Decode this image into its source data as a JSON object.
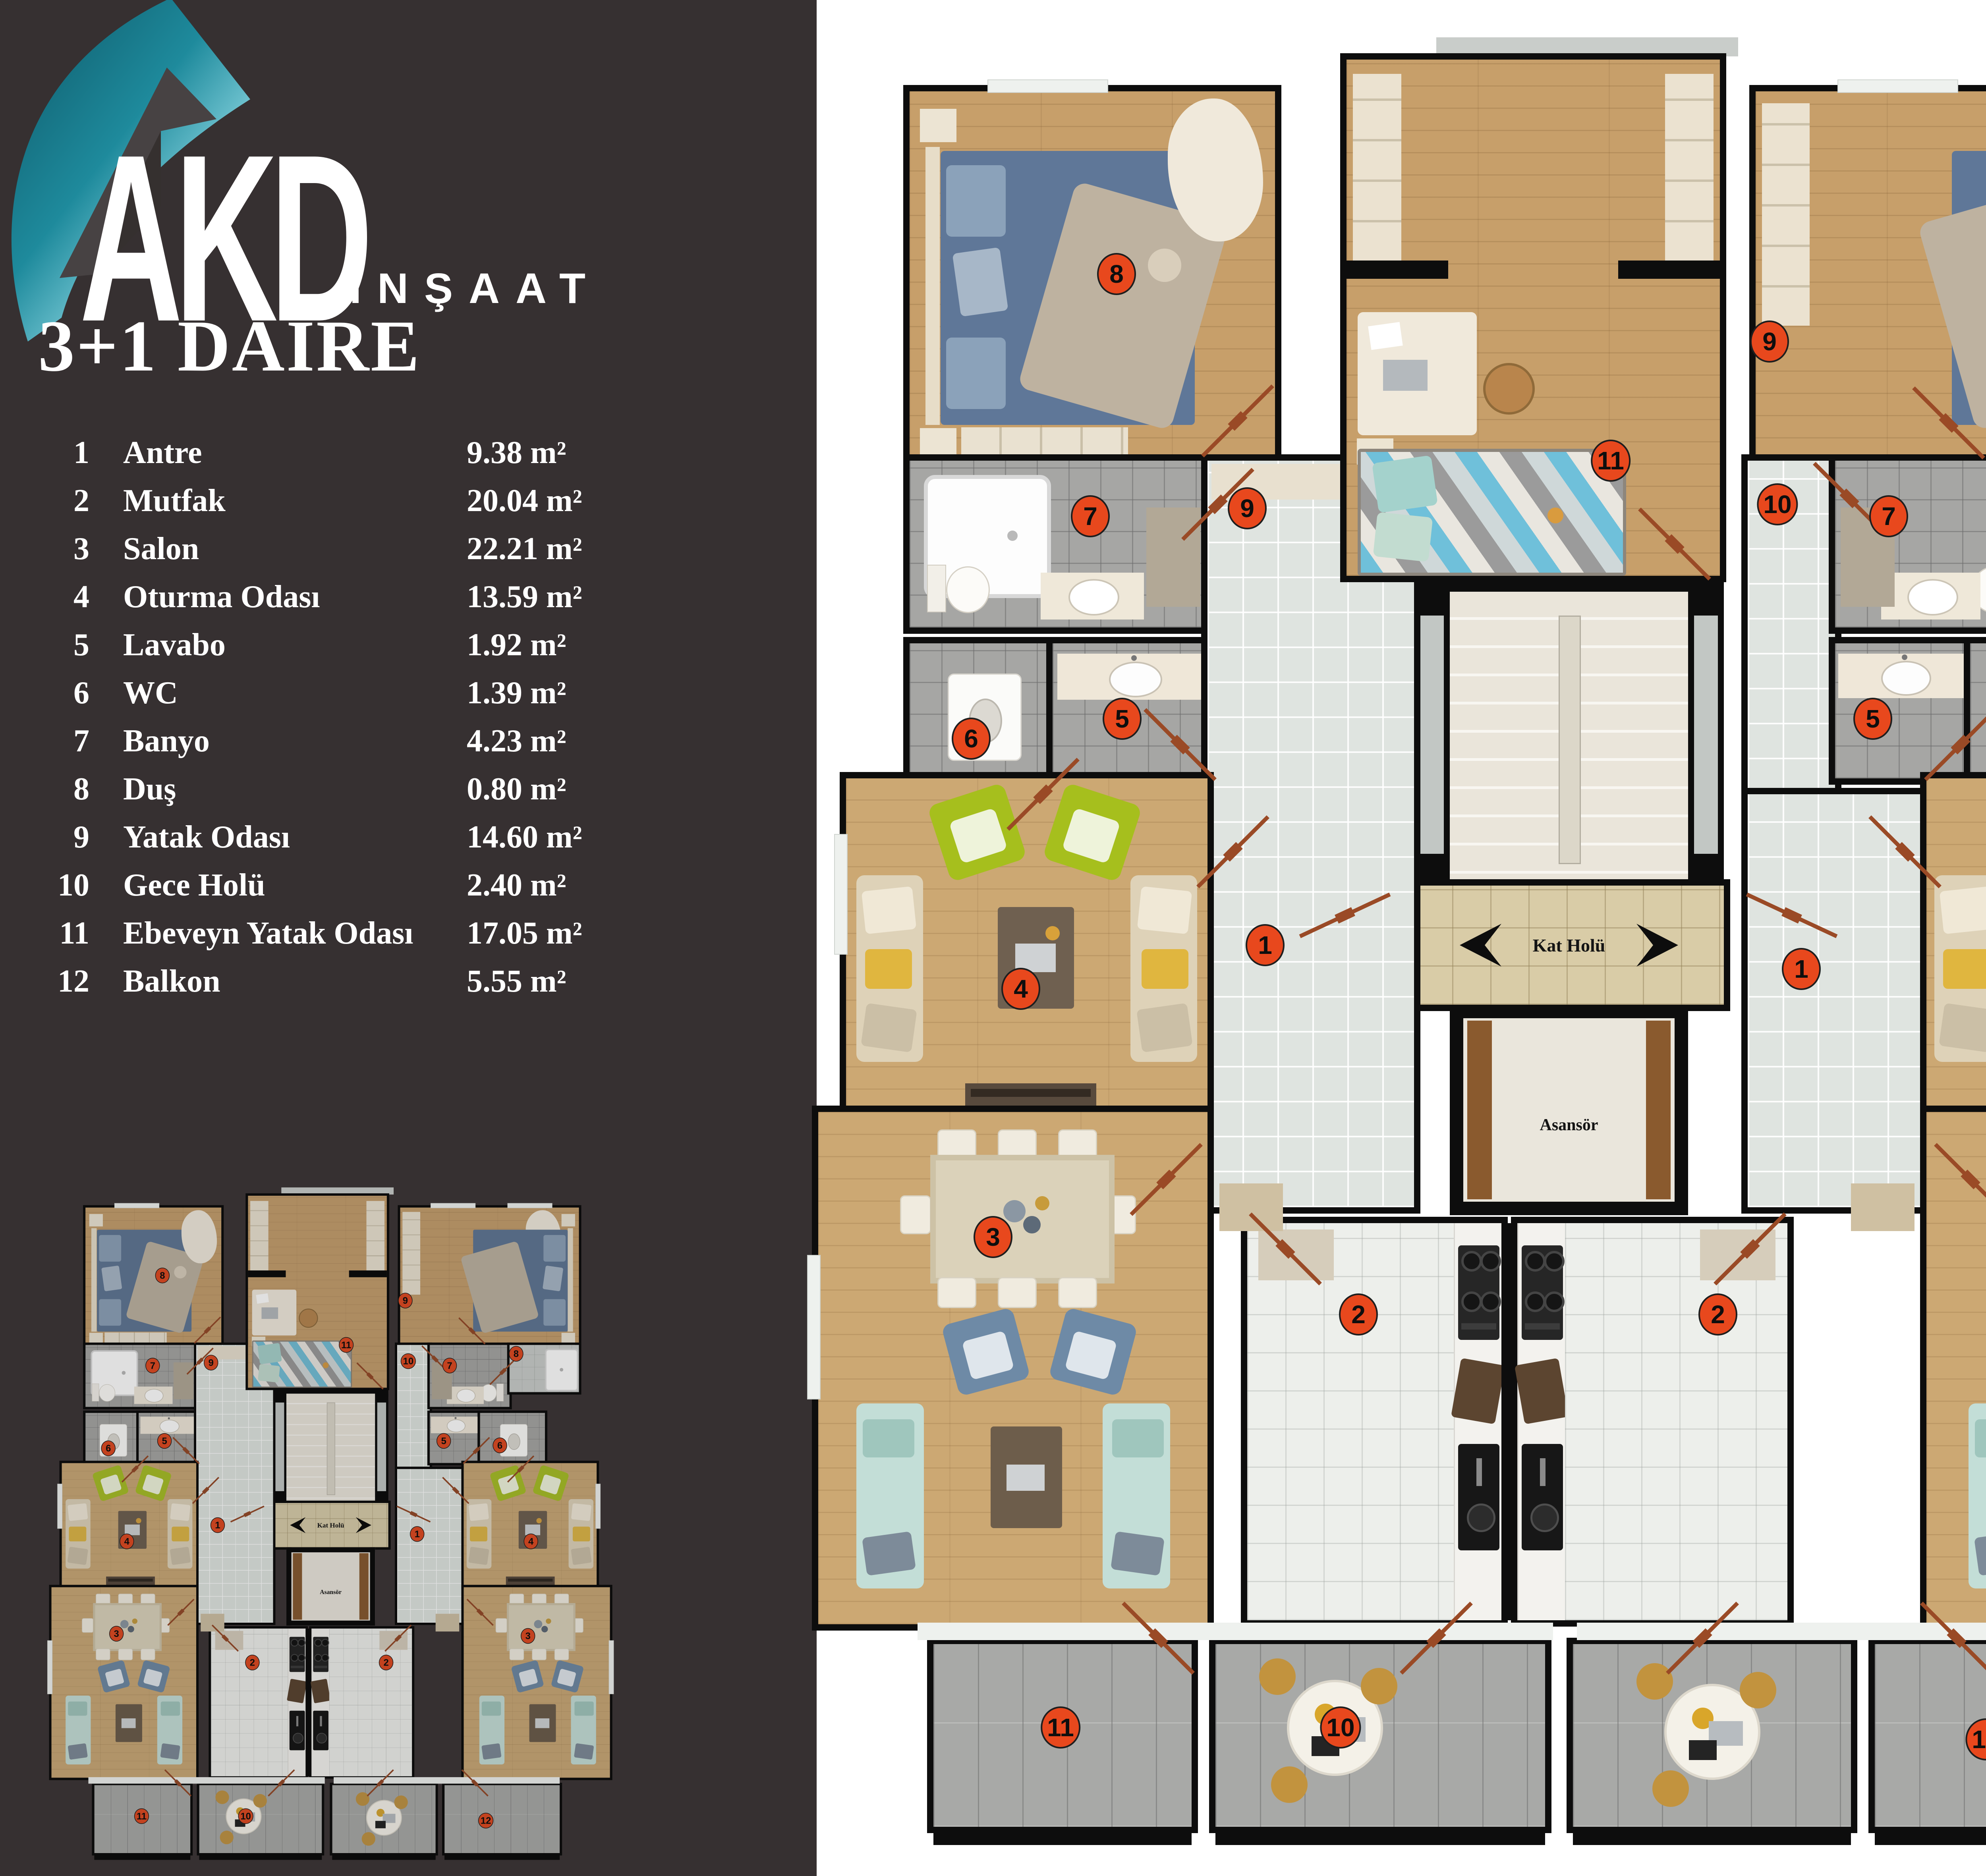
{
  "brand": {
    "name": "AKD",
    "subtitle": "İNŞAAT"
  },
  "title": "3+1 DAİRE",
  "legend": {
    "items": [
      {
        "no": "1",
        "name": "Antre",
        "area": "9.38 m²"
      },
      {
        "no": "2",
        "name": "Mutfak",
        "area": "20.04 m²"
      },
      {
        "no": "3",
        "name": "Salon",
        "area": "22.21 m²"
      },
      {
        "no": "4",
        "name": "Oturma Odası",
        "area": "13.59 m²"
      },
      {
        "no": "5",
        "name": "Lavabo",
        "area": "1.92 m²"
      },
      {
        "no": "6",
        "name": "WC",
        "area": "1.39 m²"
      },
      {
        "no": "7",
        "name": "Banyo",
        "area": "4.23 m²"
      },
      {
        "no": "8",
        "name": "Duş",
        "area": "0.80 m²"
      },
      {
        "no": "9",
        "name": "Yatak Odası",
        "area": "14.60 m²"
      },
      {
        "no": "10",
        "name": "Gece Holü",
        "area": "2.40 m²"
      },
      {
        "no": "11",
        "name": "Ebeveyn Yatak Odası",
        "area": "17.05 m²"
      },
      {
        "no": "12",
        "name": "Balkon",
        "area": "5.55 m²"
      }
    ]
  },
  "plan": {
    "hall_label": "Kat Holü",
    "elevator_label": "Asansör",
    "badges": {
      "left_bedroom": "8",
      "left_hall": "9",
      "left_bath": "7",
      "left_wc": "6",
      "left_lavabo": "5",
      "left_sitting": "4",
      "left_salon": "3",
      "left_entry": "1",
      "left_kitchen": "2",
      "left_balcony": "11",
      "center_balcony": "10",
      "master_bedroom": "11",
      "right_bedroom": "9",
      "right_hall": "10",
      "right_bath": "7",
      "right_shower": "8",
      "right_lavabo": "5",
      "right_wc": "6",
      "right_entry": "1",
      "right_sitting": "4",
      "right_salon": "3",
      "right_kitchen": "2",
      "right_balcony": "12"
    }
  },
  "colors": {
    "accent": "#e8481d",
    "background": "#363031",
    "wall": "#0d0d0d",
    "logo_teal": "#1d8496",
    "wood": "#c79f6a",
    "tile_gray": "#a6a6a4",
    "tile_light": "#dfe4e0",
    "hall_tile": "#d9cca7"
  }
}
